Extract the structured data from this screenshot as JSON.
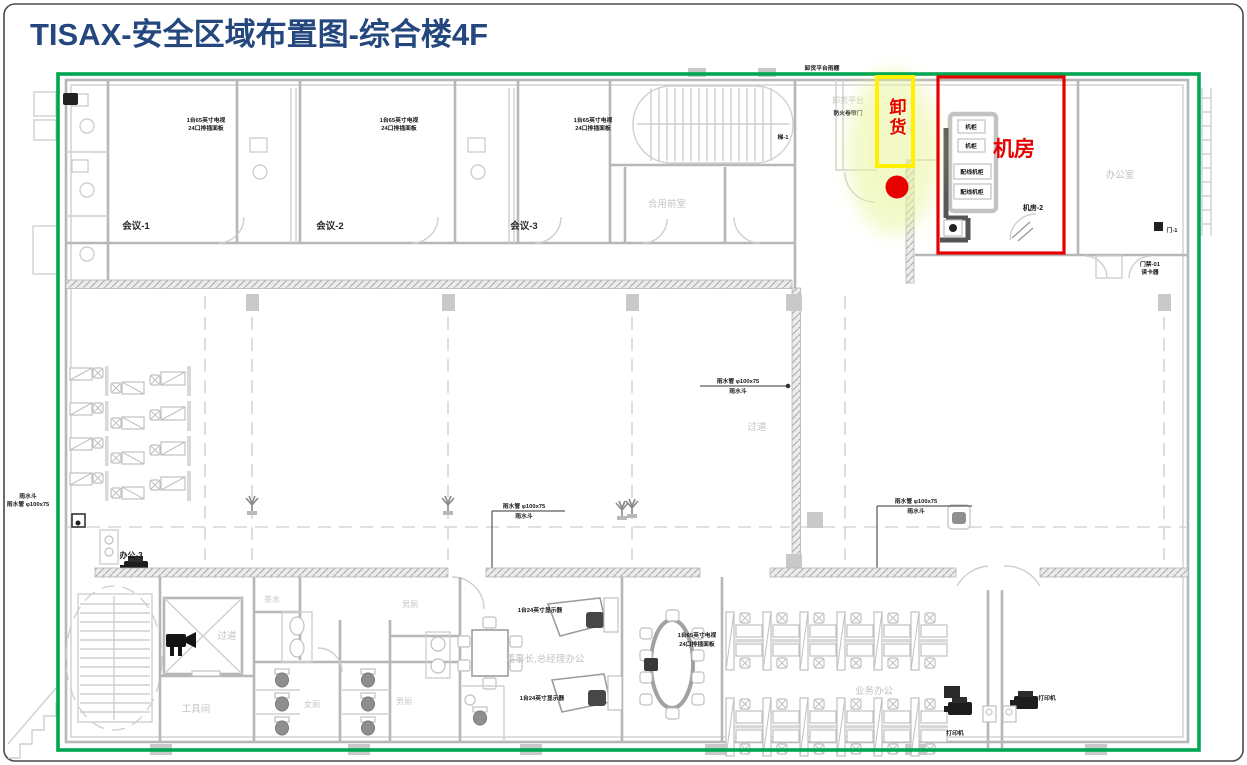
{
  "slide": {
    "title": "TISAX-安全区域布置图-综合楼4F"
  },
  "colors": {
    "title_blue": "#24477E",
    "boundary_green": "#00A651",
    "highlight_red": "#E60000",
    "highlight_yellow": "#FFF100",
    "marker_red": "#E60000",
    "cad_gray": "#B7B7B7"
  },
  "highlights": {
    "server_room_label": "机房",
    "unloading_label": "卸货"
  },
  "rooms": {
    "meeting1": "会议-1",
    "meeting2": "会议-2",
    "meeting3": "会议-3",
    "vestibule": "合用前室",
    "stair_tag": "梯-1",
    "office_right": "办公室",
    "corridor_mid": "过道",
    "corridor_bottom": "过道",
    "tea_room": "茶水",
    "male_wc_top": "男厕",
    "female_wc": "女厕",
    "male_wc_bottom": "男厕",
    "tool_room": "工具间",
    "exec_office": "董事长,总经理办公",
    "sales_office": "业务办公",
    "office_area_tag": "办公-3",
    "server_room_tag": "机房-2"
  },
  "annotations": {
    "tv_line1": "1台65英寸电视",
    "tv_line2": "24口排插面板",
    "rain_line1": "雨水管 φ100x75",
    "rain_line2": "雨水斗",
    "platform_gray": "卸货平台",
    "platform_black": "防火卷帘门",
    "roof_note": "卸货平台雨棚",
    "rack_small": "机柜",
    "rack_big": "配线机柜",
    "exec_note": "1台24英寸显示器",
    "access_line1": "门禁-01",
    "access_line2": "读卡器",
    "door_tag": "门-1",
    "printer_tag": "打印机"
  }
}
